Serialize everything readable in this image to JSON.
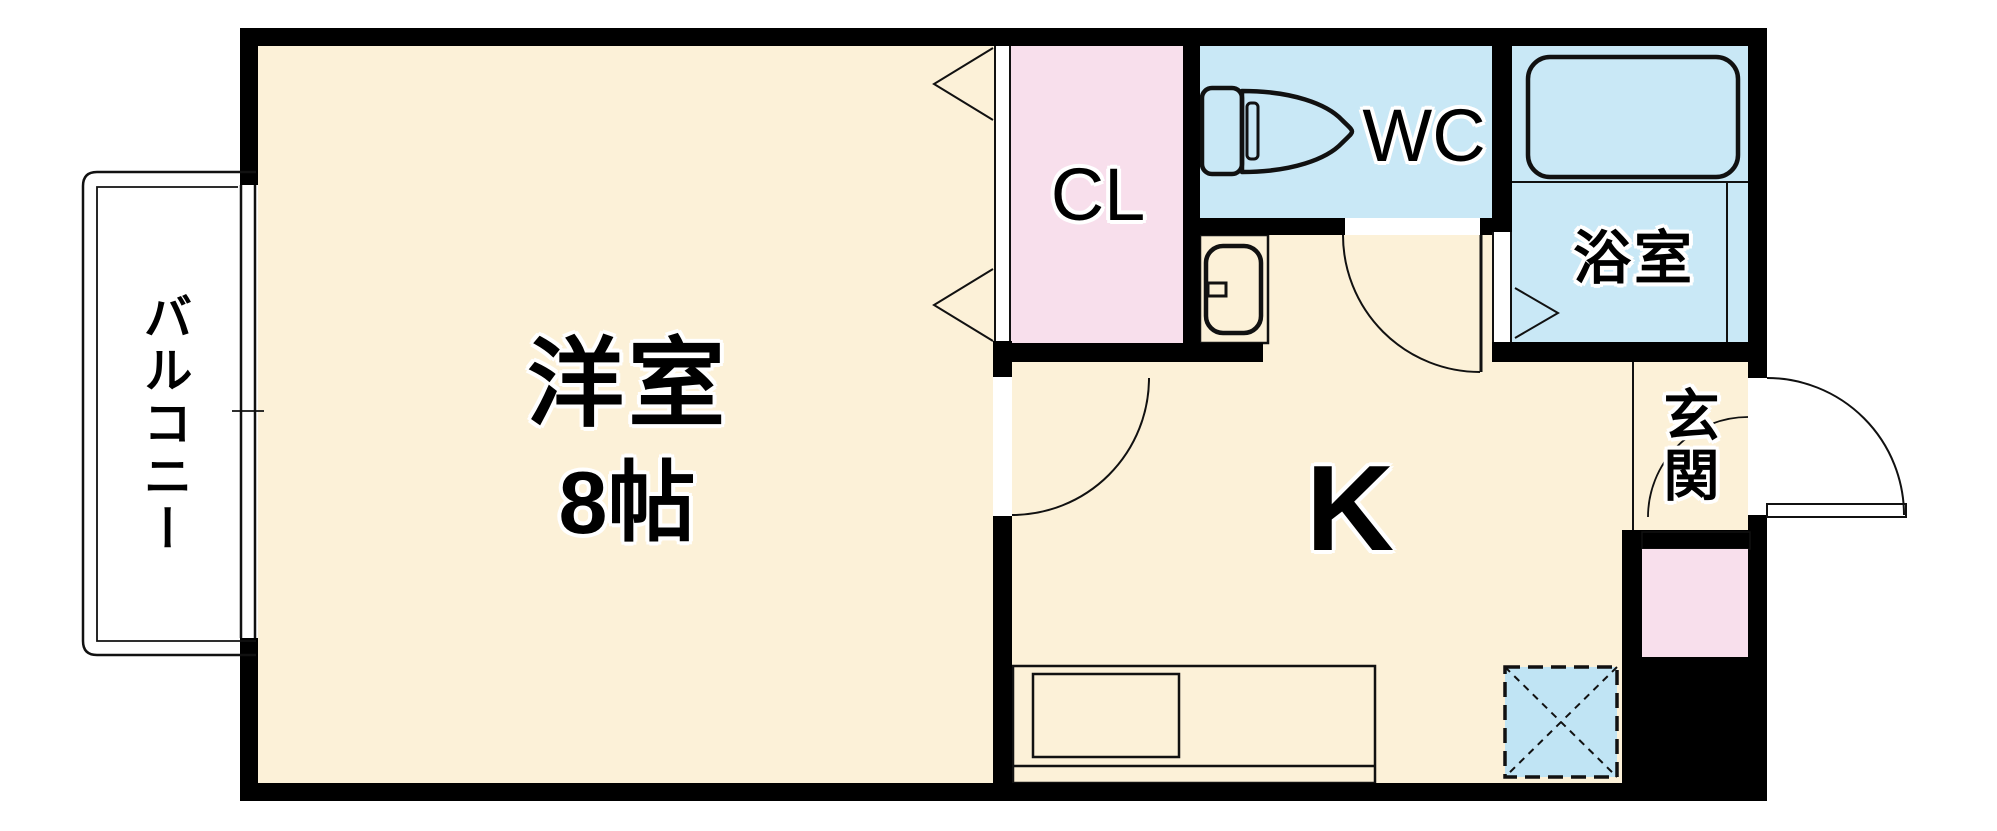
{
  "title": "1K apartment floor plan",
  "colors": {
    "wall": "#000000",
    "floor_cream": "#fcf1d8",
    "room_blue": "#c9e8f6",
    "closet_pink": "#f8dfec",
    "fixture_blue": "#cdeaf7",
    "washer_blue": "#c0e4f4",
    "line": "#111111",
    "bg": "#ffffff"
  },
  "rooms": {
    "western_room": {
      "label": "洋室",
      "size_label": "8帖"
    },
    "kitchen": {
      "label": "K"
    },
    "closet": {
      "label": "CL"
    },
    "toilet_room": {
      "label": "WC"
    },
    "bathroom": {
      "label": "浴室"
    },
    "entrance": {
      "label": "玄関"
    },
    "balcony": {
      "label": "バルコニー"
    }
  },
  "fixtures": [
    "toilet-icon",
    "washbasin-icon",
    "bathtub-icon",
    "kitchen-counter-icon",
    "washer-pan-icon",
    "hinged-door-arc",
    "folding-door-triangles",
    "sliding-window"
  ]
}
